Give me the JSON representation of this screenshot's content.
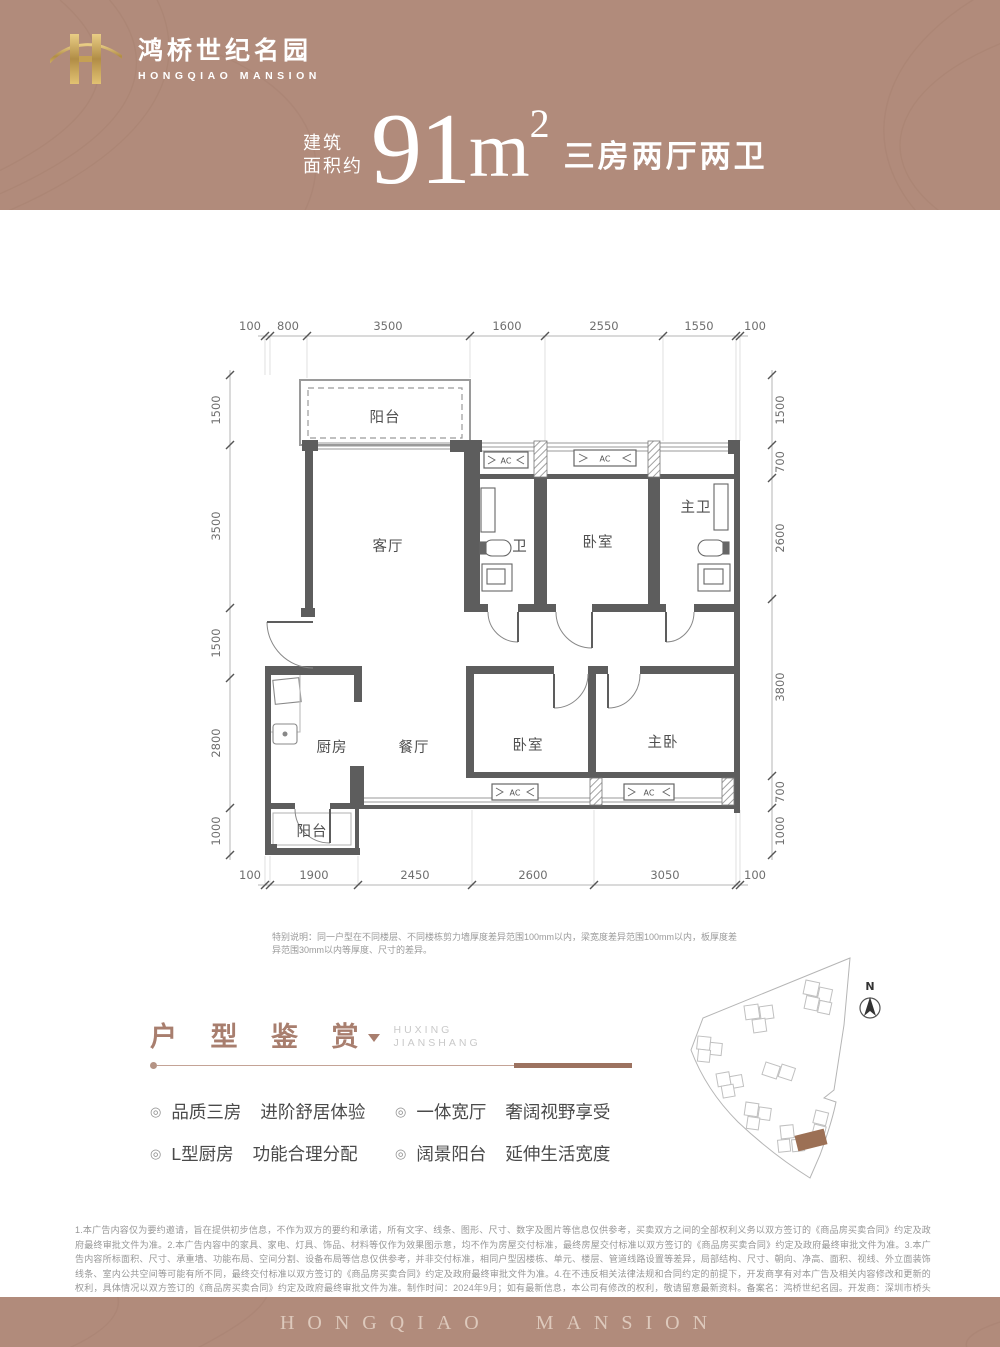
{
  "brand": {
    "name_cn": "鸿桥世纪名园",
    "name_en": "HONGQIAO MANSION"
  },
  "headline": {
    "prefix_line1": "建筑",
    "prefix_line2": "面积约",
    "area_value": "91",
    "area_unit": "m",
    "area_sup": "2",
    "suffix": "三房两厅两卫"
  },
  "floorplan": {
    "dims_top": [
      "100",
      "800",
      "3500",
      "1600",
      "2550",
      "1550",
      "100"
    ],
    "dims_bottom": [
      "100",
      "1900",
      "2450",
      "2600",
      "3050",
      "100"
    ],
    "dims_left": [
      "1500",
      "3500",
      "1500",
      "2800",
      "1000"
    ],
    "dims_right": [
      "1500",
      "700",
      "2600",
      "3800",
      "700",
      "1000"
    ],
    "rooms": {
      "balcony_top": "阳台",
      "living": "客厅",
      "bath": "卫",
      "bedroom_top": "卧室",
      "master_bath": "主卫",
      "kitchen": "厨房",
      "dining": "餐厅",
      "bedroom_bottom": "卧室",
      "master_bedroom": "主卧",
      "balcony_bottom": "阳台"
    },
    "ac_label": "AC",
    "note": "特别说明：同一户型在不同楼层、不同楼栋剪力墙厚度差异范围100mm以内，梁宽度差异范围100mm以内，板厚度差异范围30mm以内等厚度、尺寸的差异。"
  },
  "huxing": {
    "title": "户 型 鉴 赏",
    "subtitle_line1": "HUXING",
    "subtitle_line2": "JIANSHANG",
    "bullets": [
      {
        "head": "品质三房",
        "desc": "进阶舒居体验"
      },
      {
        "head": "L型厨房",
        "desc": "功能合理分配"
      },
      {
        "head": "一体宽厅",
        "desc": "奢阔视野享受"
      },
      {
        "head": "阔景阳台",
        "desc": "延伸生活宽度"
      }
    ],
    "bullet_icon": "◎"
  },
  "siteplan": {
    "north_label": "N"
  },
  "disclaimer": {
    "text": "1.本广告内容仅为要约邀请，旨在提供初步信息，不作为双方的要约和承诺，所有文字、线条、图形、尺寸、数字及图片等信息仅供参考，买卖双方之间的全部权利义务以双方签订的《商品房买卖合同》约定及政府最终审批文件为准。2.本广告内容中的家具、家电、灯具、饰品、材料等仅作为效果图示意，均不作为房屋交付标准，最终房屋交付标准以双方签订的《商品房买卖合同》约定及政府最终审批文件为准。3.本广告内容所标面积、尺寸、承重墙、功能布局、空间分割、设备布局等信息仅供参考，并非交付标准，相同户型因楼栋、单元、楼层、管道线路设置等差异，局部结构、尺寸、朝向、净高、面积、视线、外立面装饰线条、室内公共空间等可能有所不同，最终交付标准以双方签订的《商品房买卖合同》约定及政府最终审批文件为准。4.在不违反相关法律法规和合同约定的前提下，开发商享有对本广告及相关内容修改和更新的权利，具体情况以双方签订的《商品房买卖合同》约定及政府最终审批文件为准。制作时间：2024年9月；如有最新信息，本公司有修改的权利，敬请留意最新资料。备案名：鸿桥世纪名园。开发商：深圳市桥头房地产开发有限公司。"
  },
  "footer": {
    "text": "HONGQIAO  MANSION"
  },
  "colors": {
    "band": "#b18b7b",
    "accent": "#9c7260",
    "gold": "#cfa85f",
    "wall": "#5d5d5d"
  }
}
